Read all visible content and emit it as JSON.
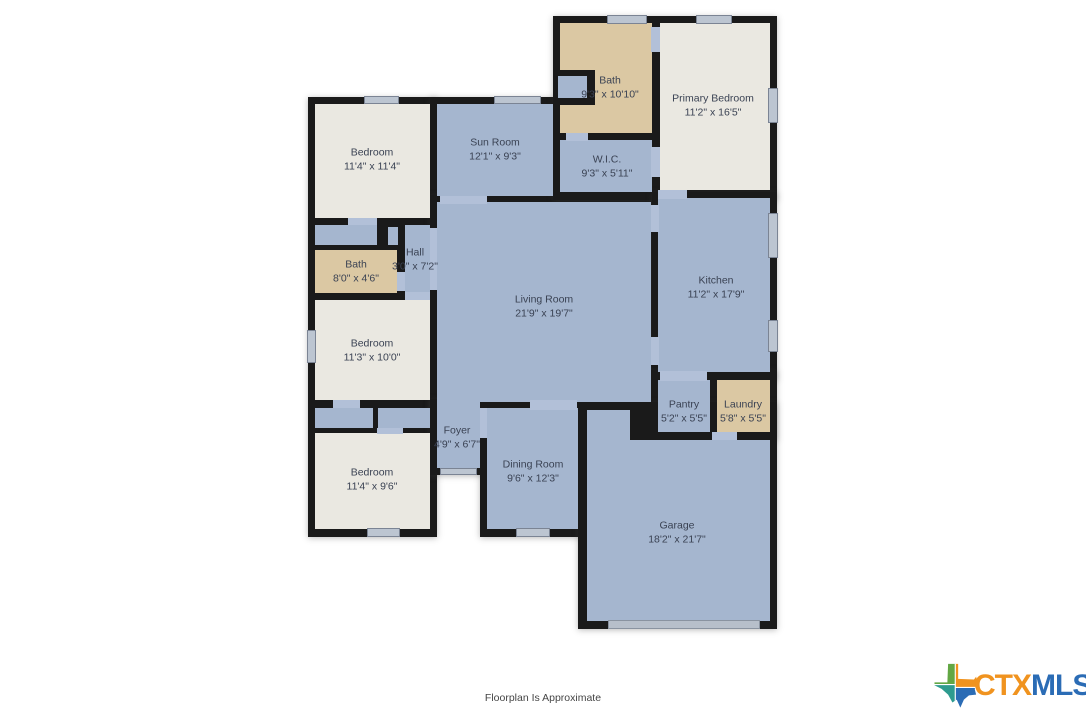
{
  "footer": {
    "disclaimer": "Floorplan Is Approximate"
  },
  "logo": {
    "prefix": "CTX",
    "suffix": "MLS",
    "prefix_color": "#f0931f",
    "suffix_color": "#2b6cb5",
    "icon_colors": {
      "green": "#62a744",
      "orange": "#f0931f",
      "teal": "#2e9b8f",
      "blue": "#2b6cb5"
    }
  },
  "palette": {
    "wall": "#1a1a1a",
    "room_blue": "#a5b6cf",
    "room_cream": "#eae8e1",
    "room_tan": "#dbc8a3",
    "opening": "#b2c0d8",
    "window": "#bcc5d1",
    "label_text": "#3a4253"
  },
  "rooms": [
    {
      "id": "bedroom-1",
      "label": "Bedroom",
      "dims": "11'4\" x 11'4\""
    },
    {
      "id": "sun-room",
      "label": "Sun Room",
      "dims": "12'1\" x 9'3\""
    },
    {
      "id": "bath-primary",
      "label": "Bath",
      "dims": "9'3\" x 10'10\""
    },
    {
      "id": "primary-bedroom",
      "label": "Primary Bedroom",
      "dims": "11'2\" x 16'5\""
    },
    {
      "id": "wic",
      "label": "W.I.C.",
      "dims": "9'3\" x 5'11\""
    },
    {
      "id": "hall",
      "label": "Hall",
      "dims": "3'0\" x 7'2\""
    },
    {
      "id": "bath-2",
      "label": "Bath",
      "dims": "8'0\" x 4'6\""
    },
    {
      "id": "bedroom-2",
      "label": "Bedroom",
      "dims": "11'3\" x 10'0\""
    },
    {
      "id": "living-room",
      "label": "Living Room",
      "dims": "21'9\" x 19'7\""
    },
    {
      "id": "kitchen",
      "label": "Kitchen",
      "dims": "11'2\" x 17'9\""
    },
    {
      "id": "pantry",
      "label": "Pantry",
      "dims": "5'2\" x 5'5\""
    },
    {
      "id": "laundry",
      "label": "Laundry",
      "dims": "5'8\" x 5'5\""
    },
    {
      "id": "foyer",
      "label": "Foyer",
      "dims": "4'9\" x 6'7\""
    },
    {
      "id": "bedroom-3",
      "label": "Bedroom",
      "dims": "11'4\" x 9'6\""
    },
    {
      "id": "dining-room",
      "label": "Dining Room",
      "dims": "9'6\" x 12'3\""
    },
    {
      "id": "garage",
      "label": "Garage",
      "dims": "18'2\" x 21'7\""
    }
  ]
}
